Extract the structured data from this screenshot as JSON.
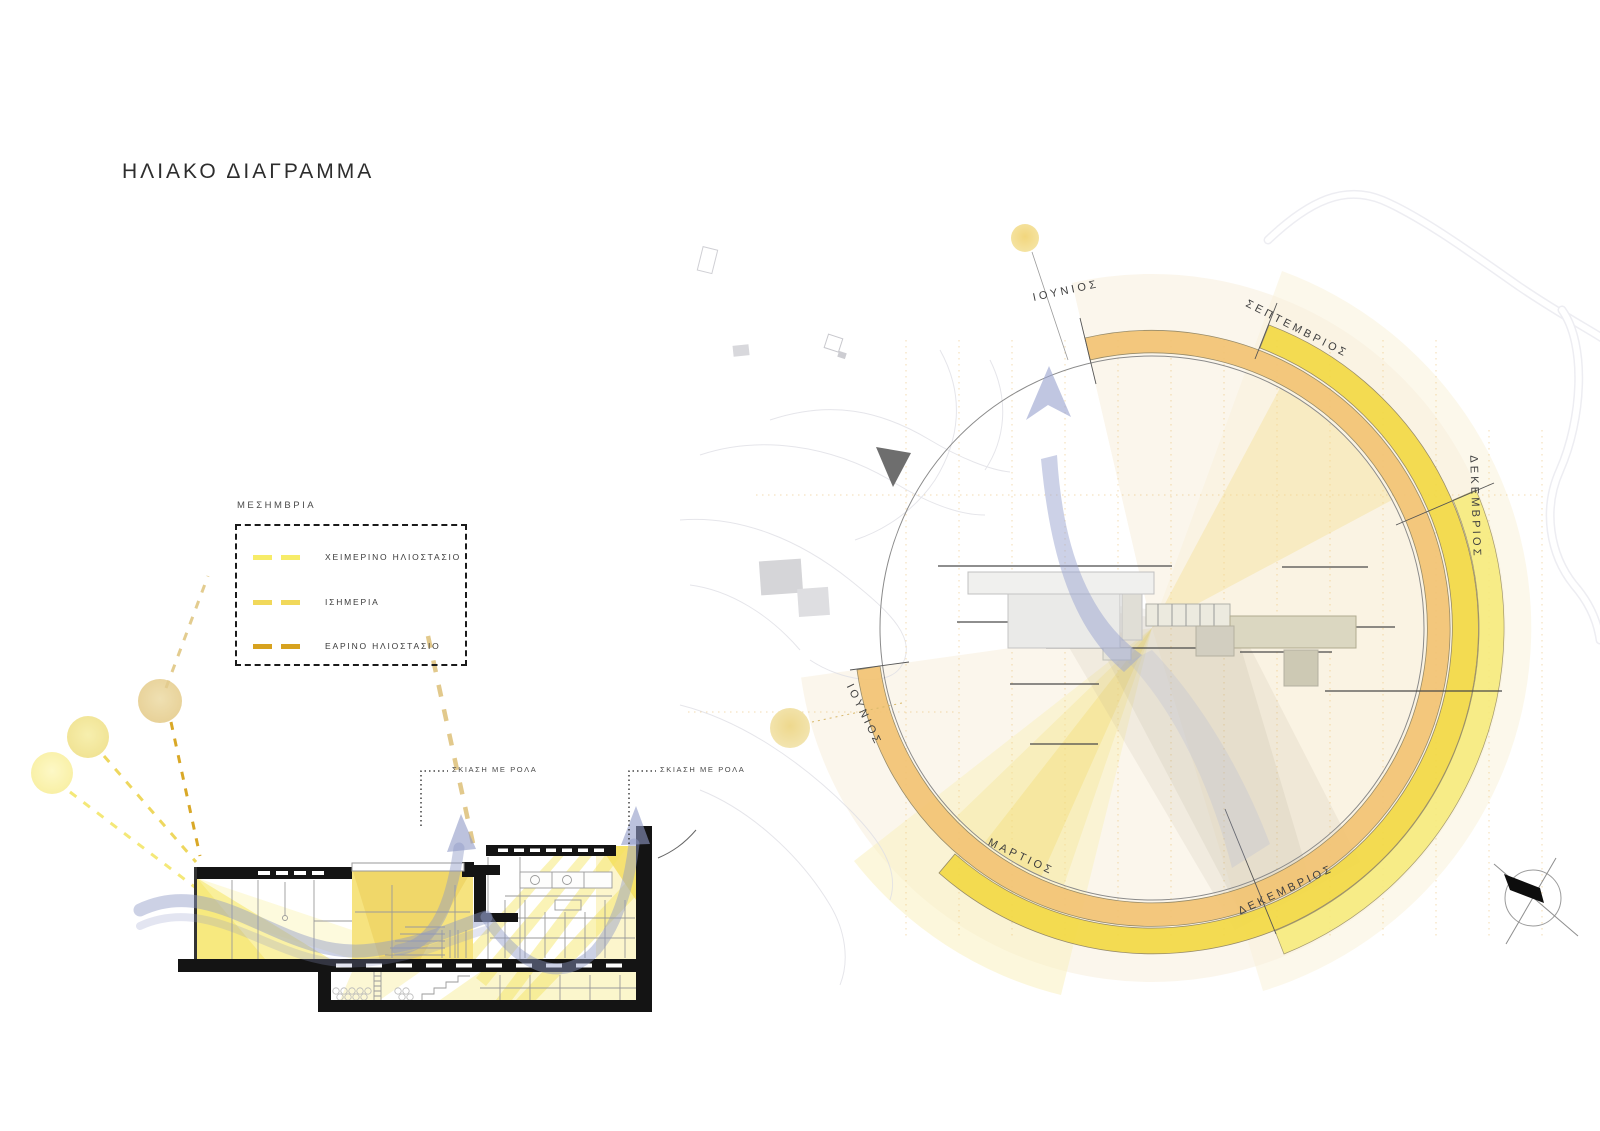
{
  "page": {
    "title": "ΗΛΙΑΚΟ ΔΙΑΓΡΑΜΜΑ",
    "background": "#ffffff"
  },
  "legend": {
    "header": "ΜΕΣΗΜΒΡΙΑ",
    "items": [
      {
        "label": "ΧΕΙΜΕΡΙΝΟ ΗΛΙΟΣΤΑΣΙΟ",
        "color": "#f7ec68"
      },
      {
        "label": "ΙΣΗΜΕΡΙΑ",
        "color": "#f1d85a"
      },
      {
        "label": "ΕΑΡΙΝΟ ΗΛΙΟΣΤΑΣΙΟ",
        "color": "#d7a21f"
      }
    ]
  },
  "section": {
    "labels": [
      {
        "text": "ΣΚΙΑΣΗ ΜΕ ΡΟΛΑ"
      },
      {
        "text": "ΣΚΙΑΣΗ ΜΕ ΡΟΛΑ"
      }
    ]
  },
  "sun_diagram": {
    "months": [
      {
        "label": "ΙΟΥΝΙΟΣ",
        "position": "top"
      },
      {
        "label": "ΣΕΠΤΕΜΒΡΙΟΣ",
        "position": "upper-right"
      },
      {
        "label": "ΔΕΚΕΜΒΡΙΟΣ",
        "position": "right"
      },
      {
        "label": "ΔΕΚΕΜΒΡΙΟΣ",
        "position": "bottom-right"
      },
      {
        "label": "ΜΑΡΤΙΟΣ",
        "position": "bottom-left"
      },
      {
        "label": "ΙΟΥΝΙΟΣ",
        "position": "left"
      }
    ],
    "bands": [
      {
        "name": "june-equinox-arc",
        "color": "#f3c474"
      },
      {
        "name": "september-march-arc",
        "color": "#f3d945"
      },
      {
        "name": "december-arc",
        "color": "#f7ec7e"
      }
    ]
  }
}
